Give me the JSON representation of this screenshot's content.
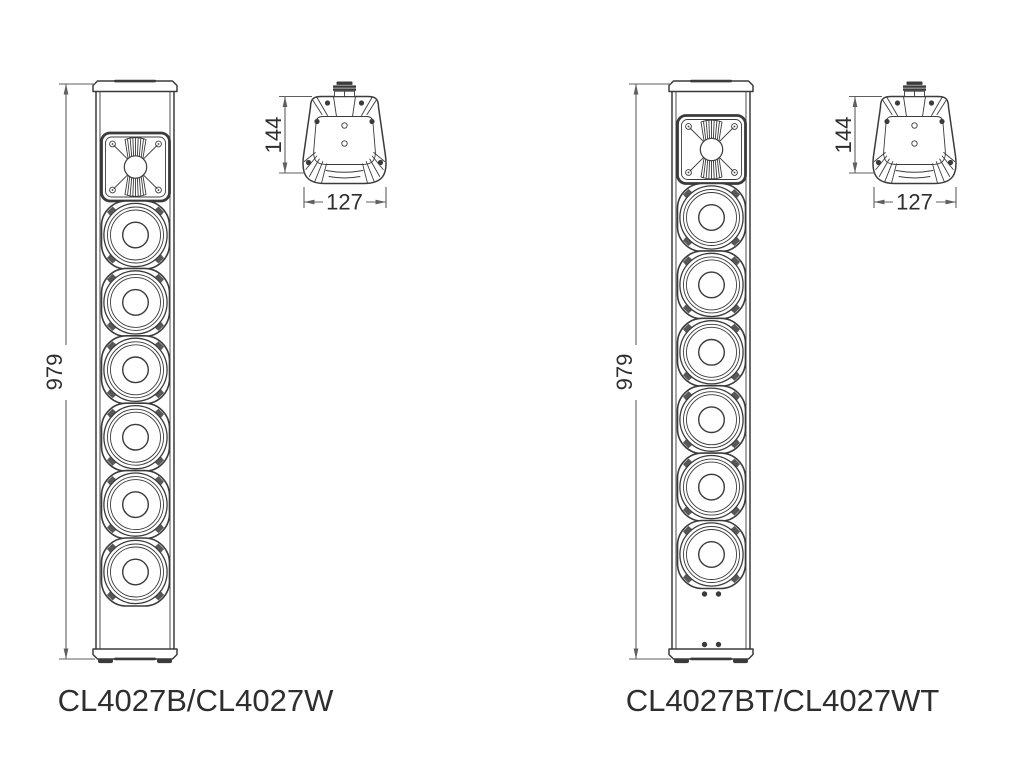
{
  "colors": {
    "background": "#ffffff",
    "line": "#3b3b3b",
    "dim_line": "#5f5f5f",
    "text": "#2e2e2e"
  },
  "drawings": [
    {
      "model_label": "CL4027B/CL4027W",
      "front_view": {
        "height_dim": "979",
        "woofer_count": 6,
        "tweeter_count": 1
      },
      "top_view": {
        "depth_dim": "144",
        "width_dim": "127"
      }
    },
    {
      "model_label": "CL4027BT/CL4027WT",
      "front_view": {
        "height_dim": "979",
        "woofer_count": 6,
        "tweeter_count": 1,
        "bottom_screw_count": 4
      },
      "top_view": {
        "depth_dim": "144",
        "width_dim": "127"
      }
    }
  ]
}
